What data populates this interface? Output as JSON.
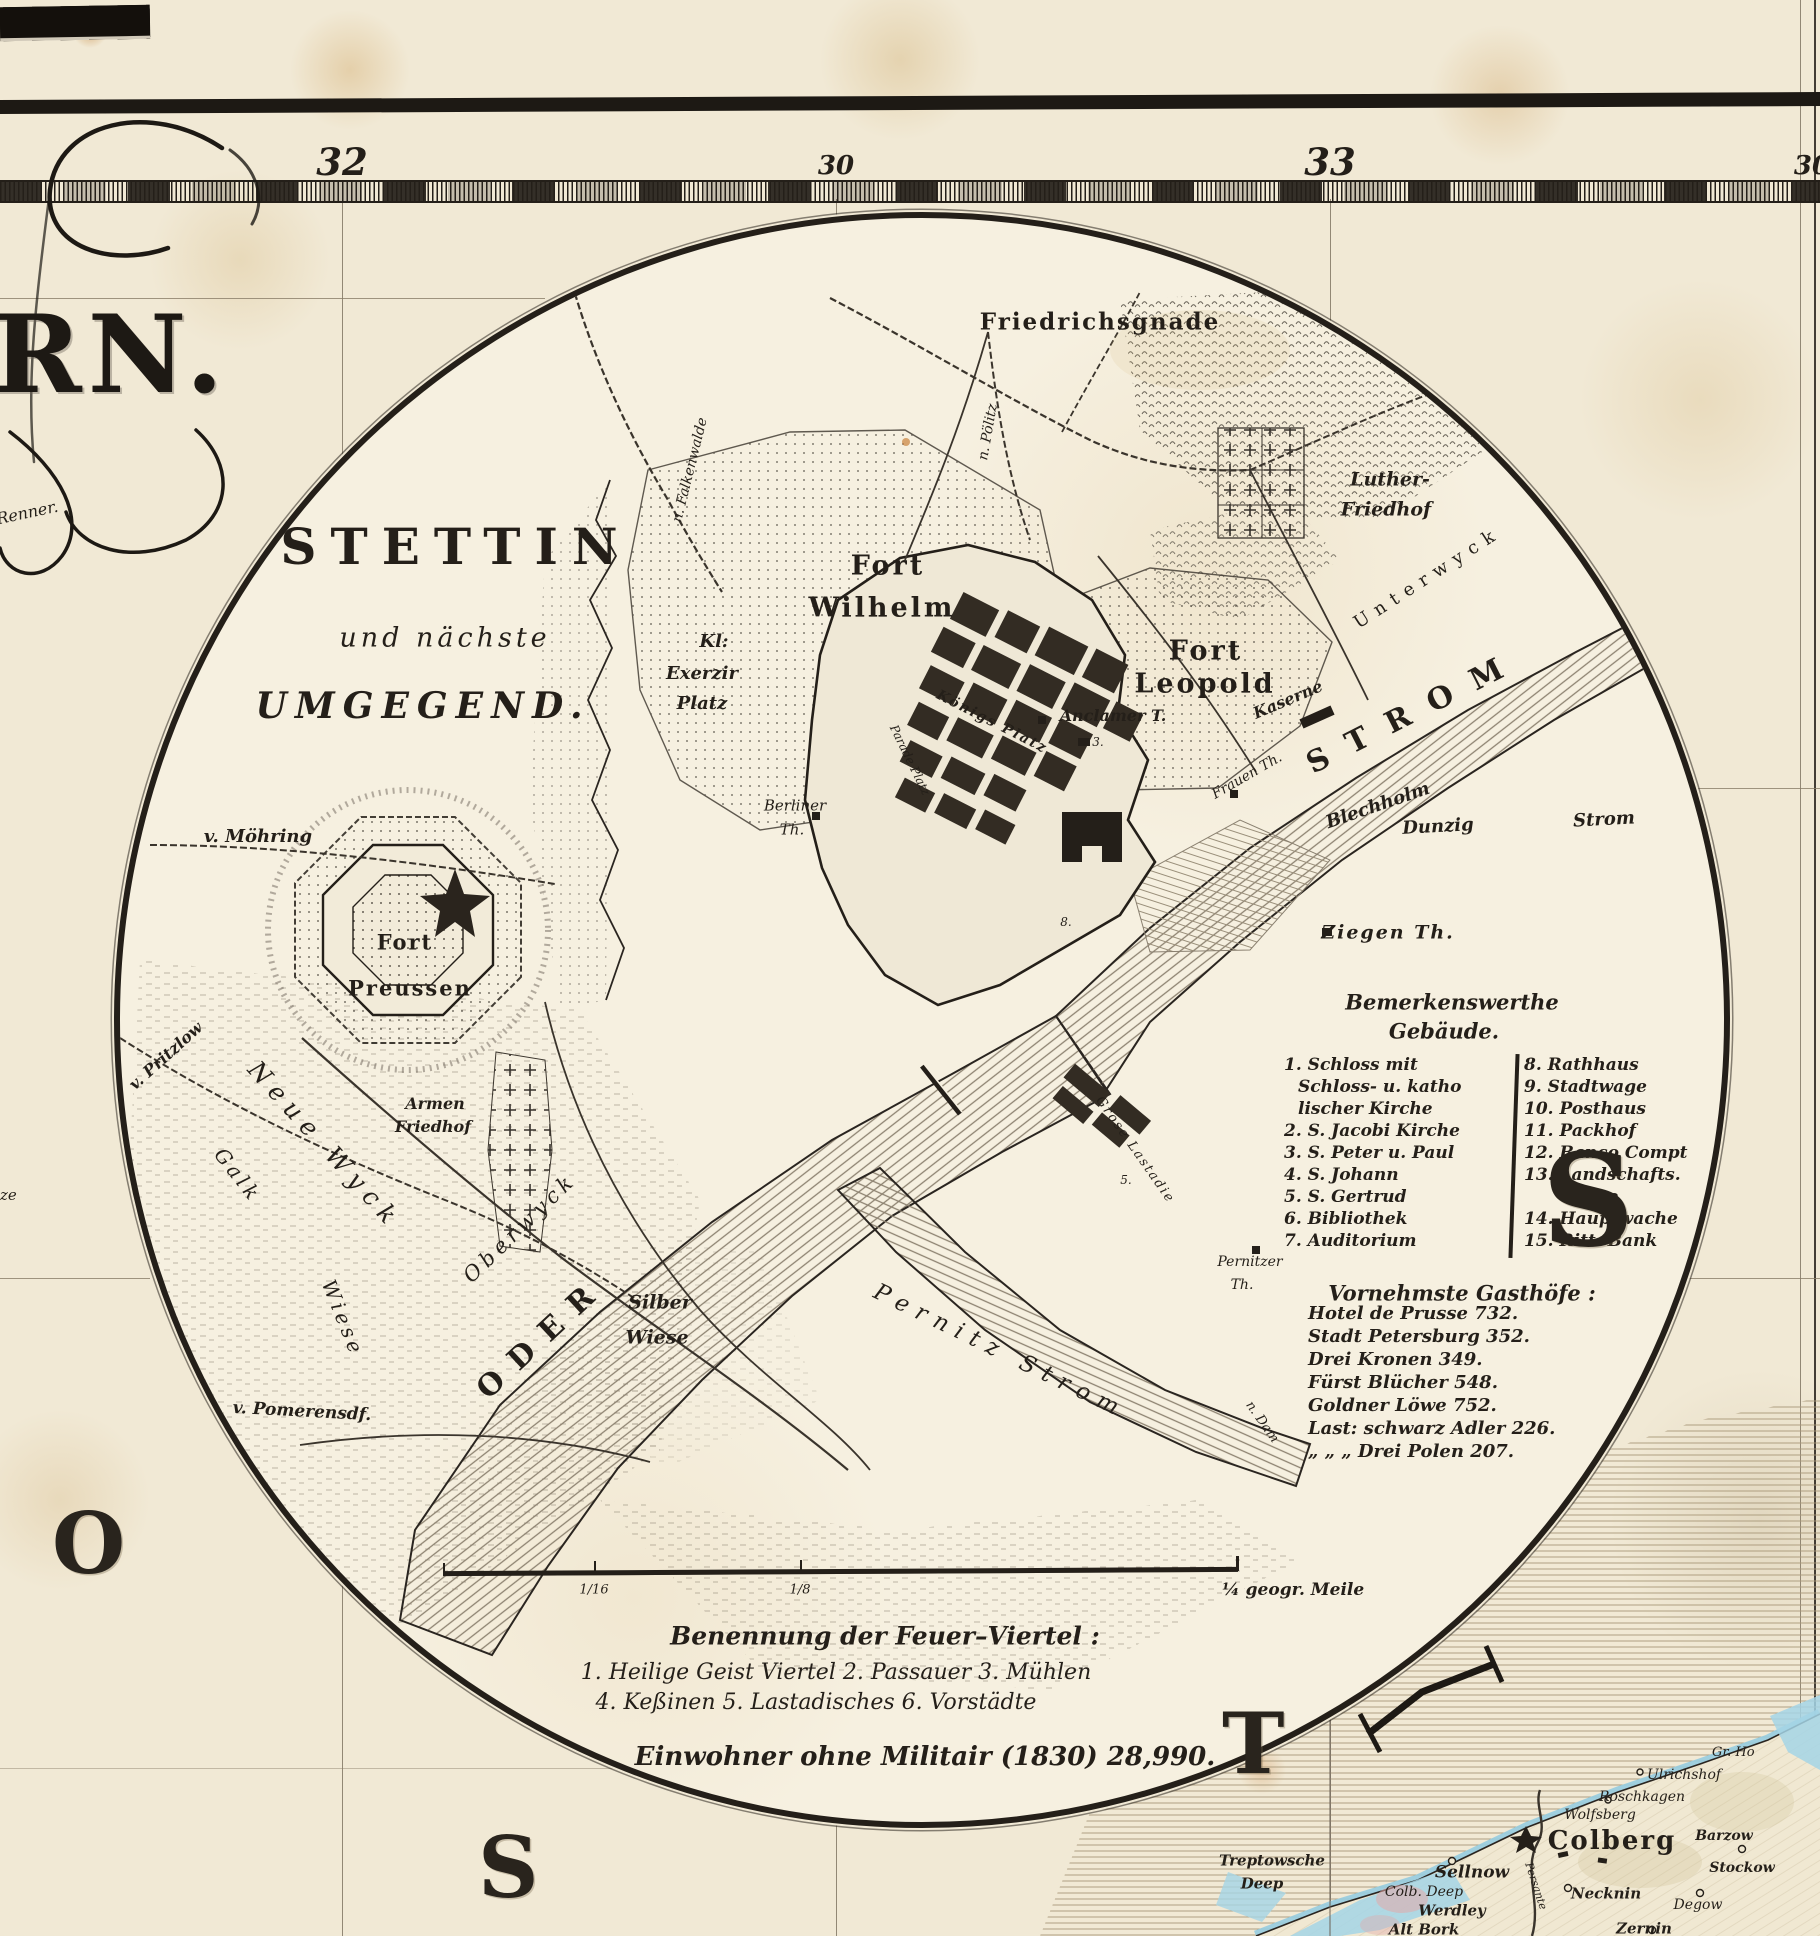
{
  "frame": {
    "ruler_numbers": [
      "32",
      "30",
      "33",
      "30"
    ]
  },
  "cartouche": {
    "fragment": "RN.",
    "engraver": "Renner.",
    "edge_fragment": "ze"
  },
  "inset": {
    "title": "STETTIN",
    "subtitle1": "und nächste",
    "subtitle2": "UMGEGEND.",
    "labels": {
      "friedrichsgnade": "Friedrichsgnade",
      "luther1": "Luther-",
      "luther2": "Friedhof",
      "fort_wilhelm1": "Fort",
      "fort_wilhelm2": "Wilhelm",
      "fort_leopold1": "Fort",
      "fort_leopold2": "Leopold",
      "fort_preussen1": "Fort",
      "fort_preussen2": "Preussen",
      "kl1": "Kl:",
      "kl2": "Exerzir",
      "kl3": "Platz",
      "v_moehring": "v. Möhring",
      "armen1": "Armen",
      "armen2": "Friedhof",
      "neue_wyck": "Neue Wyck",
      "galk": "Galk",
      "wiese": "Wiese",
      "v_pritzlow": "v. Pritzlow",
      "ober_wyck": "Oberwyck",
      "v_pomerensdf": "v. Pomerensdf.",
      "oder": "ODER",
      "silber1": "Silber",
      "silber2": "Wiese",
      "pernitz_strom": "Pernitz Strom",
      "pernitzer1": "Pernitzer",
      "pernitzer2": "Th.",
      "n_damm": "n. Dam",
      "ziegen_th": "Ziegen Th.",
      "blechholm": "Blechholm",
      "dunzig": "Dunzig",
      "dunzig_strom": "Strom",
      "strom_big": "STROM",
      "unterwyck": "Unterwyck",
      "kaserne": "Kaserne",
      "frauen_th": "Frauen Th.",
      "anclamer": "Anclamer T.",
      "koenigs_platz": "Königs Platz",
      "parade_platz": "Parade Platz",
      "berliner1": "Berliner",
      "berliner2": "Th.",
      "n_falkenwalde": "n. Falkenwalde",
      "n_poelitz": "n. Pölitz",
      "grosse_lastadie": "Grose Lastadie",
      "num3": "3.",
      "num8": "8.",
      "num5": "5."
    },
    "legend": {
      "title1": "Bemerkenswerthe",
      "title2": "Gebäude.",
      "left": [
        "1. Schloss mit",
        "Schloss- u. katho",
        "lischer Kirche",
        "2. S. Jacobi Kirche",
        "3. S. Peter u. Paul",
        "4. S. Johann",
        "5. S. Gertrud",
        "6. Bibliothek",
        "7. Auditorium"
      ],
      "right": [
        "8. Rathhaus",
        "9. Stadtwage",
        "10. Posthaus",
        "11. Packhof",
        "12. Banco Compt",
        "13. Landschafts.",
        "Casse",
        "14. Hauptwache",
        "15. Ritt. Bank"
      ]
    },
    "hotels": {
      "title": "Vornehmste Gasthöfe :",
      "items": [
        "Hotel de Prusse 732.",
        "Stadt Petersburg 352.",
        "Drei Kronen 349.",
        "Fürst Blücher 548.",
        "Goldner Löwe 752.",
        "Last: schwarz Adler 226.",
        "„ „ „ Drei Polen 207."
      ]
    },
    "scale": {
      "t16": "1/16",
      "t8": "1/8",
      "right": "¼ geogr. Meile"
    },
    "quarters": {
      "heading": "Benennung der Feuer–Viertel :",
      "line1": "1. Heilige Geist Viertel  2. Passauer  3. Mühlen",
      "line2": "4. Keßinen  5. Lastadisches  6. Vorstädte"
    },
    "population": "Einwohner ohne Militair (1830) 28,990."
  },
  "sea": {
    "letters": [
      "O",
      "S",
      "T",
      "S"
    ]
  },
  "coast": {
    "towns": {
      "treptowsche1": "Treptowsche",
      "treptowsche2": "Deep",
      "sellnow": "Sellnow",
      "colb_deep": "Colb. Deep",
      "werdley": "Werdley",
      "alt_bork": "Alt Bork",
      "colberg": "Colberg",
      "wolfsberg": "Wolfsberg",
      "roschkagen": "Roschkagen",
      "ulrichshof": "Ulrichshof",
      "gr_ho": "Gr. Ho",
      "barzow": "Barzow",
      "stockow": "Stockow",
      "necknin": "Necknin",
      "degow": "Degow",
      "zernin": "Zernin",
      "persante": "Persante"
    }
  }
}
